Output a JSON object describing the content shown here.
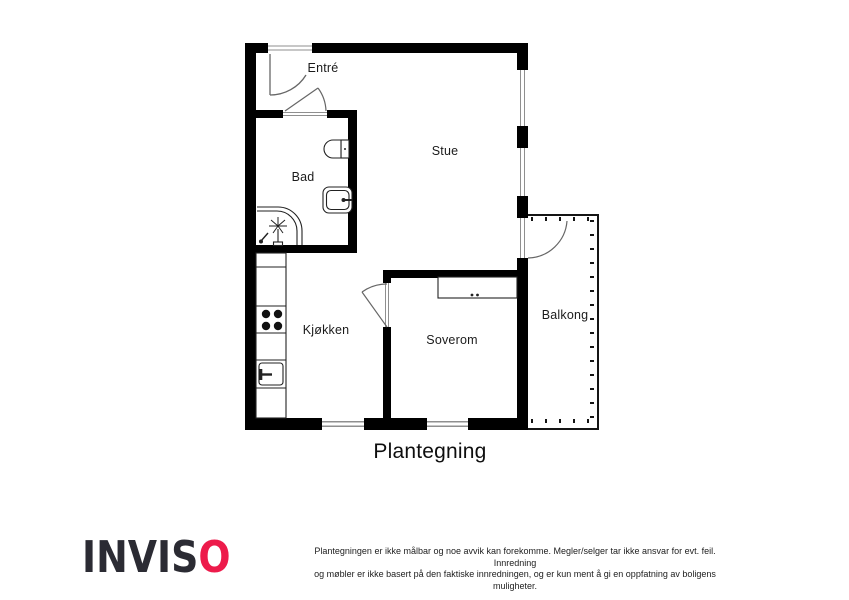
{
  "page": {
    "title": "Plantegning"
  },
  "rooms": {
    "entre": {
      "label": "Entré"
    },
    "bad": {
      "label": "Bad"
    },
    "stue": {
      "label": "Stue"
    },
    "kjokken": {
      "label": "Kjøkken"
    },
    "soverom": {
      "label": "Soverom"
    },
    "balkong": {
      "label": "Balkong"
    }
  },
  "fixtures": {
    "bathroom": [
      "toilet-icon",
      "sink-icon",
      "corner-shower-icon"
    ],
    "kitchen": [
      "counter-icon",
      "stove-4-burner-icon",
      "kitchen-sink-icon"
    ],
    "bedroom": [
      "wardrobe-icon"
    ],
    "doors": [
      "entry-door-swing-icon",
      "bathroom-door-swing-icon",
      "bedroom-door-swing-icon",
      "balcony-door-swing-icon"
    ]
  },
  "branding": {
    "logo_prefix": "INVIS",
    "logo_accent_letter": "O",
    "logo_dark_color": "#2b2b33",
    "logo_accent_color": "#ed1b4b"
  },
  "disclaimer": {
    "line1": "Plantegningen er ikke målbar og noe avvik kan forekomme. Megler/selger tar ikke ansvar for evt. feil. Innredning",
    "line2": "og møbler er ikke basert på den faktiske innredningen, og er kun ment å gi en oppfatning av boligens muligheter."
  },
  "colors": {
    "wall": "#000000",
    "fixture_line": "#222222",
    "glazing": "#8f8f8f",
    "balcony_line": "#151515"
  }
}
